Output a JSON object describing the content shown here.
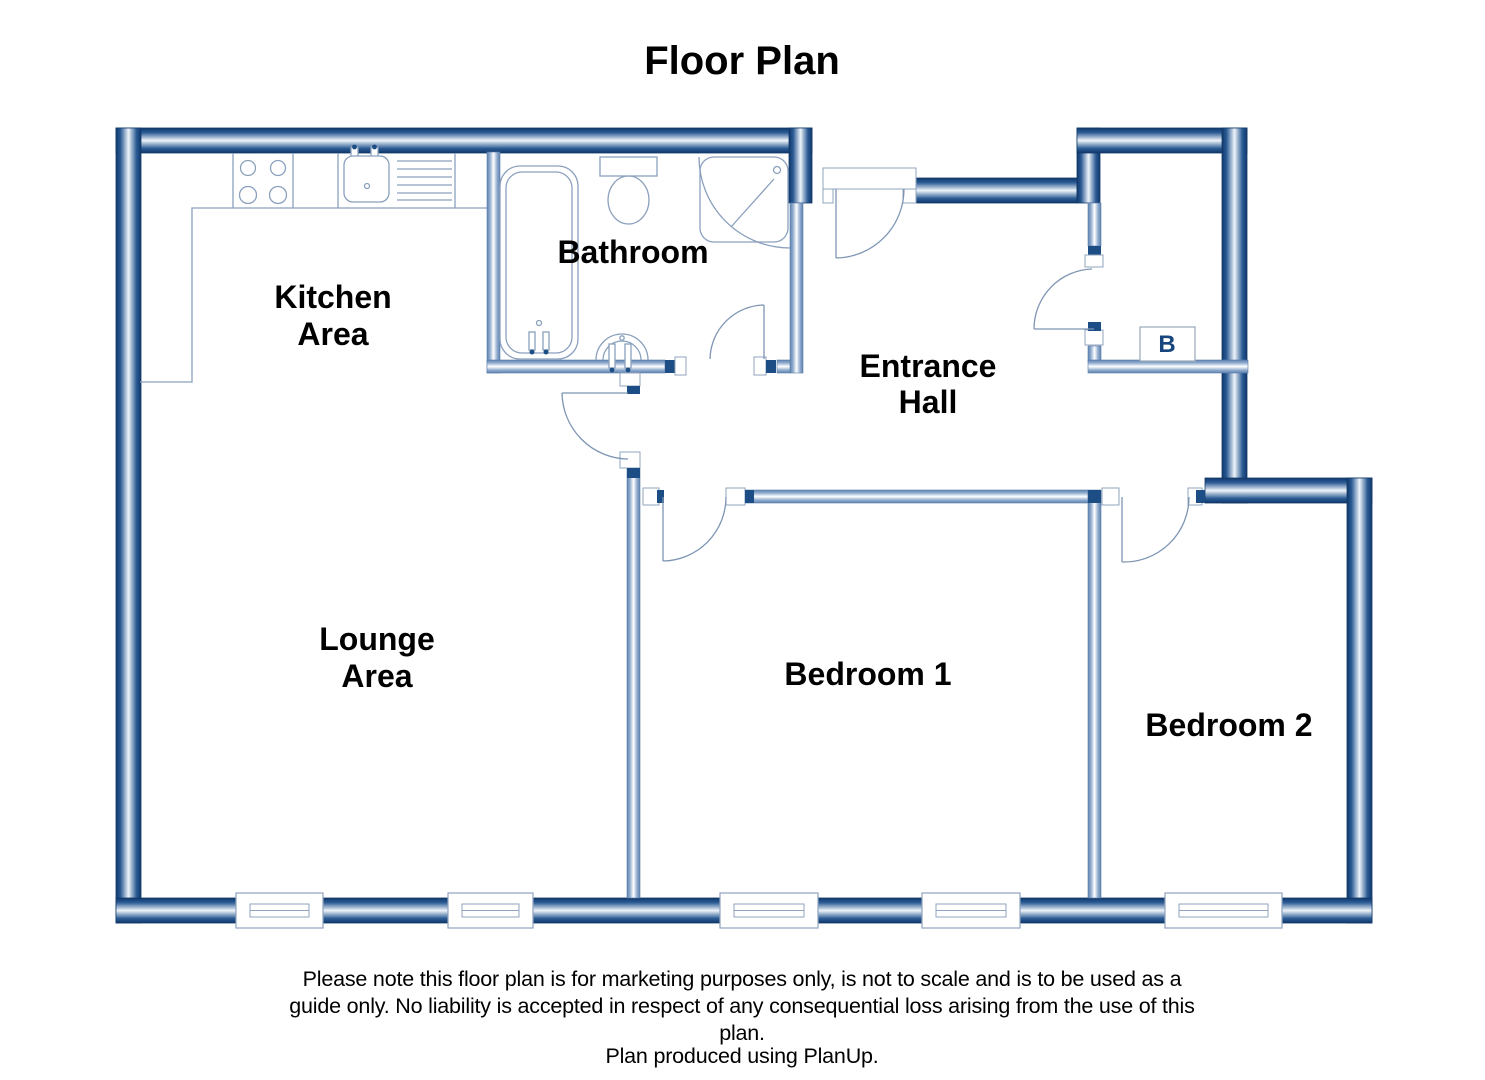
{
  "title": "Floor Plan",
  "rooms": {
    "kitchen": {
      "line1": "Kitchen",
      "line2": "Area"
    },
    "bathroom": {
      "label": "Bathroom"
    },
    "entrance_hall": {
      "line1": "Entrance",
      "line2": "Hall"
    },
    "lounge": {
      "line1": "Lounge",
      "line2": "Area"
    },
    "bedroom1": {
      "label": "Bedroom 1"
    },
    "bedroom2": {
      "label": "Bedroom 2"
    },
    "boiler": {
      "label": "B"
    }
  },
  "disclaimer": {
    "line1": "Please note this floor plan is for marketing purposes only, is not to scale and is to be used as a",
    "line2": "guide only.  No liability is accepted in respect of any consequential loss arising from the use of this",
    "line3": "plan.",
    "line4": "Plan produced using PlanUp."
  },
  "colors": {
    "outer_wall": "#16406f",
    "outer_wall_mid": "#eef4fa",
    "interior_wall": "#6486b3",
    "fixture_line": "#8aa0bd",
    "label_text": "#000000",
    "boiler_text": "#17457d"
  }
}
